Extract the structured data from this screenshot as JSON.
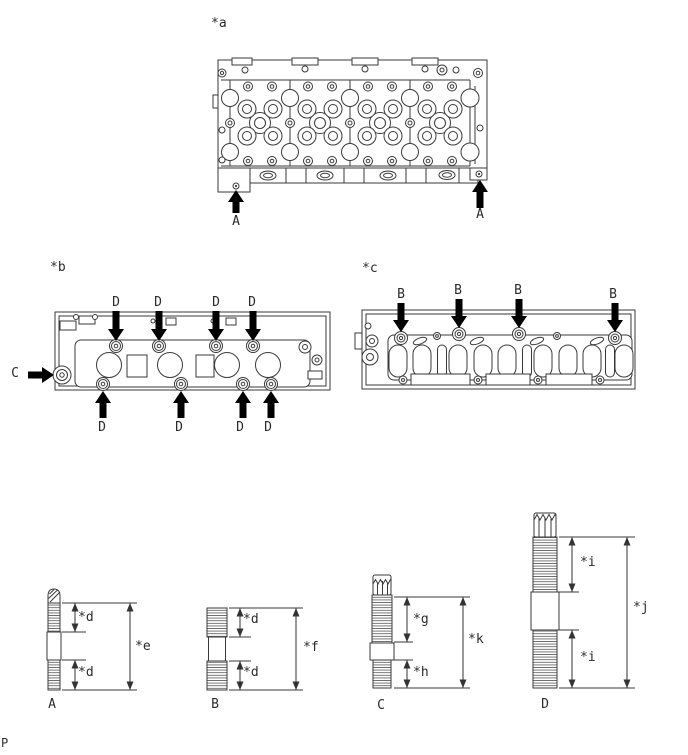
{
  "colors": {
    "line": "#3a3a3a",
    "arrow": "#000000",
    "background": "#ffffff"
  },
  "fig_a": {
    "tag": "*a",
    "arrow_left": "A",
    "arrow_right": "A"
  },
  "fig_b": {
    "tag": "*b",
    "top_arrows": [
      "D",
      "D",
      "D",
      "D"
    ],
    "left_arrow": "C",
    "bottom_arrows": [
      "D",
      "D",
      "D",
      "D"
    ]
  },
  "fig_c": {
    "tag": "*c",
    "arrows": [
      "B",
      "B",
      "B",
      "B"
    ]
  },
  "studs": {
    "a": {
      "label": "A",
      "dim_upper": "*d",
      "dim_lower": "*d",
      "dim_overall": "*e"
    },
    "b": {
      "label": "B",
      "dim_upper": "*d",
      "dim_lower": "*d",
      "dim_overall": "*f"
    },
    "c": {
      "label": "C",
      "dim_upper": "*g",
      "dim_lower": "*h",
      "dim_overall": "*k"
    },
    "d": {
      "label": "D",
      "dim_upper": "*i",
      "dim_lower": "*i",
      "dim_overall": "*j"
    }
  },
  "page_marker": "P"
}
